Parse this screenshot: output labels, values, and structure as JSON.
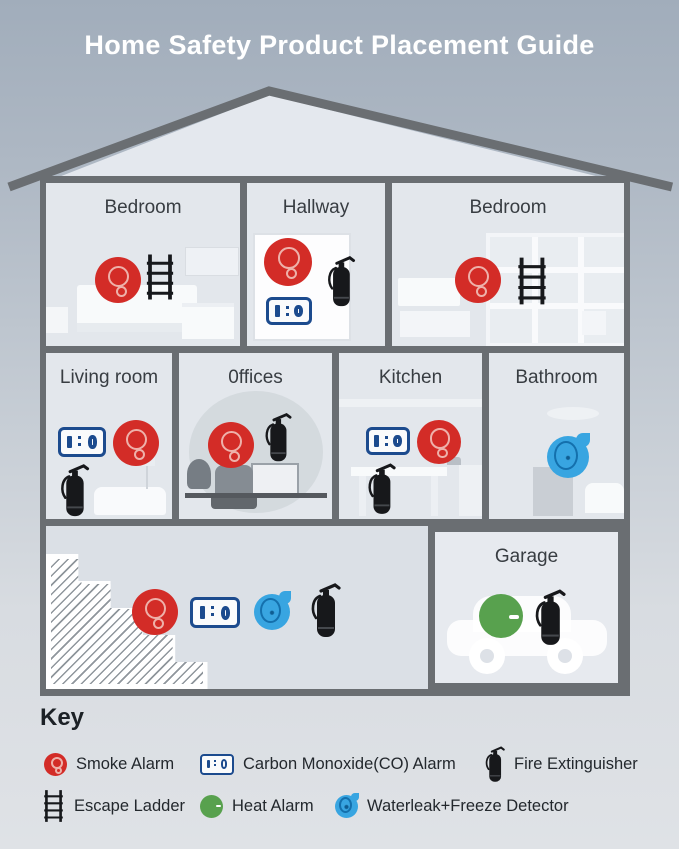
{
  "title": "Home Safety Product Placement Guide",
  "rooms": [
    {
      "name": "Bedroom",
      "devices": [
        "smoke-alarm",
        "escape-ladder"
      ]
    },
    {
      "name": "Hallway",
      "devices": [
        "smoke-alarm",
        "fire-extinguisher",
        "co-alarm"
      ]
    },
    {
      "name": "Bedroom",
      "devices": [
        "smoke-alarm",
        "escape-ladder"
      ]
    },
    {
      "name": "Living room",
      "devices": [
        "co-alarm",
        "smoke-alarm",
        "fire-extinguisher"
      ]
    },
    {
      "name": "0ffices",
      "devices": [
        "smoke-alarm",
        "fire-extinguisher"
      ]
    },
    {
      "name": "Kitchen",
      "devices": [
        "co-alarm",
        "smoke-alarm",
        "fire-extinguisher"
      ]
    },
    {
      "name": "Bathroom",
      "devices": [
        "waterleak-freeze-detector"
      ]
    },
    {
      "name": "Garage",
      "devices": [
        "heat-alarm",
        "fire-extinguisher"
      ]
    }
  ],
  "basement": {
    "devices": [
      "smoke-alarm",
      "co-alarm",
      "waterleak-freeze-detector",
      "fire-extinguisher"
    ]
  },
  "co_alarm_display": "1:0",
  "key": {
    "title": "Key",
    "items": [
      {
        "icon": "smoke-alarm-icon",
        "label": "Smoke Alarm"
      },
      {
        "icon": "co-alarm-icon",
        "label": "Carbon Monoxide(CO) Alarm"
      },
      {
        "icon": "fire-extinguisher-icon",
        "label": "Fire Extinguisher"
      },
      {
        "icon": "escape-ladder-icon",
        "label": "Escape Ladder"
      },
      {
        "icon": "heat-alarm-icon",
        "label": "Heat Alarm"
      },
      {
        "icon": "waterleak-freeze-detector-icon",
        "label": "Waterleak+Freeze Detector"
      }
    ]
  },
  "colors": {
    "smoke_alarm": "#d32c27",
    "co_alarm": "#1c4b8e",
    "fire_extinguisher": "#17181b",
    "heat_alarm": "#58a14e",
    "waterleak_detector": "#38a5e1",
    "walls": "#6a6e72",
    "title_text": "#ffffff",
    "background_top": "#a1adbb",
    "background_bottom": "#dfe2e6"
  }
}
